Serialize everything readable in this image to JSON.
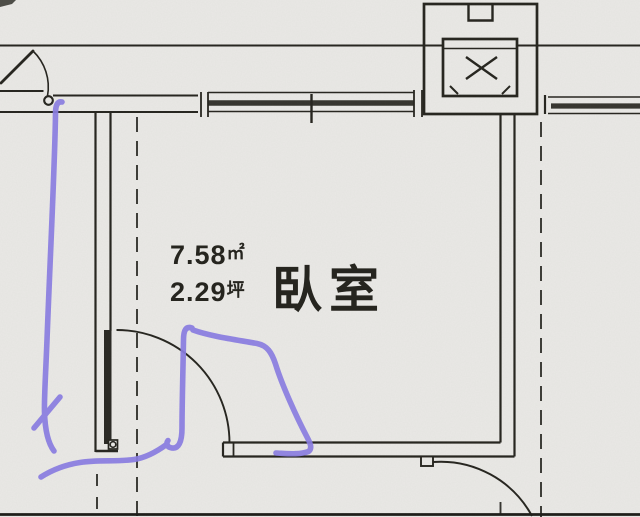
{
  "room": {
    "label": "臥室",
    "area_sqm_value": "7.58",
    "area_sqm_unit": "㎡",
    "area_ping_value": "2.29",
    "area_ping_unit": "坪"
  },
  "colors": {
    "paper": "#eae9e6",
    "ink": "#26251f",
    "annotation_purple": "#8a7de3"
  }
}
